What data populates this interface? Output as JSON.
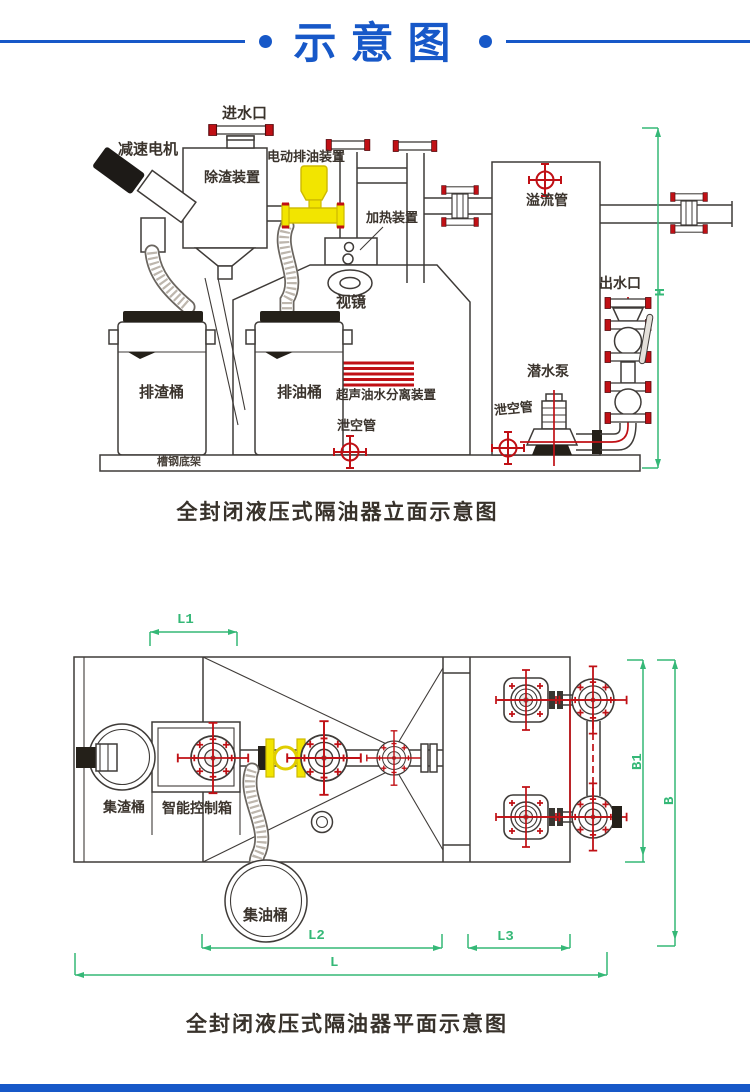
{
  "header": {
    "title": "示意图"
  },
  "colors": {
    "accent_blue": "#1758c8",
    "diagram_red": "#c01015",
    "device_yellow": "#f2e500",
    "dimension_green": "#35b877",
    "line_dark": "#3f3b38"
  },
  "elevation": {
    "caption": "全封闭液压式隔油器立面示意图",
    "labels": {
      "water_inlet": "进水口",
      "gear_motor": "减速电机",
      "slag_removal_device": "除渣装置",
      "electric_oil_discharge_device": "电动排油装置",
      "heating_device": "加热装置",
      "overflow_pipe": "溢流管",
      "sight_glass": "视镜",
      "water_outlet": "出水口",
      "slag_discharge_barrel": "排渣桶",
      "oil_discharge_barrel": "排油桶",
      "ultrasonic_separator": "超声油水分离装置",
      "submersible_pump": "潜水泵",
      "drain_pipe_left": "泄空管",
      "drain_pipe_right": "泄空管",
      "steel_base_frame": "槽钢底架",
      "dim_h": "H"
    }
  },
  "plan": {
    "caption": "全封闭液压式隔油器平面示意图",
    "labels": {
      "slag_collection_barrel": "集渣桶",
      "smart_control_box": "智能控制箱",
      "oil_collection_barrel": "集油桶",
      "dim_l1": "L1",
      "dim_b1": "B1",
      "dim_b": "B",
      "dim_l2": "L2",
      "dim_l3": "L3",
      "dim_l": "L"
    }
  }
}
